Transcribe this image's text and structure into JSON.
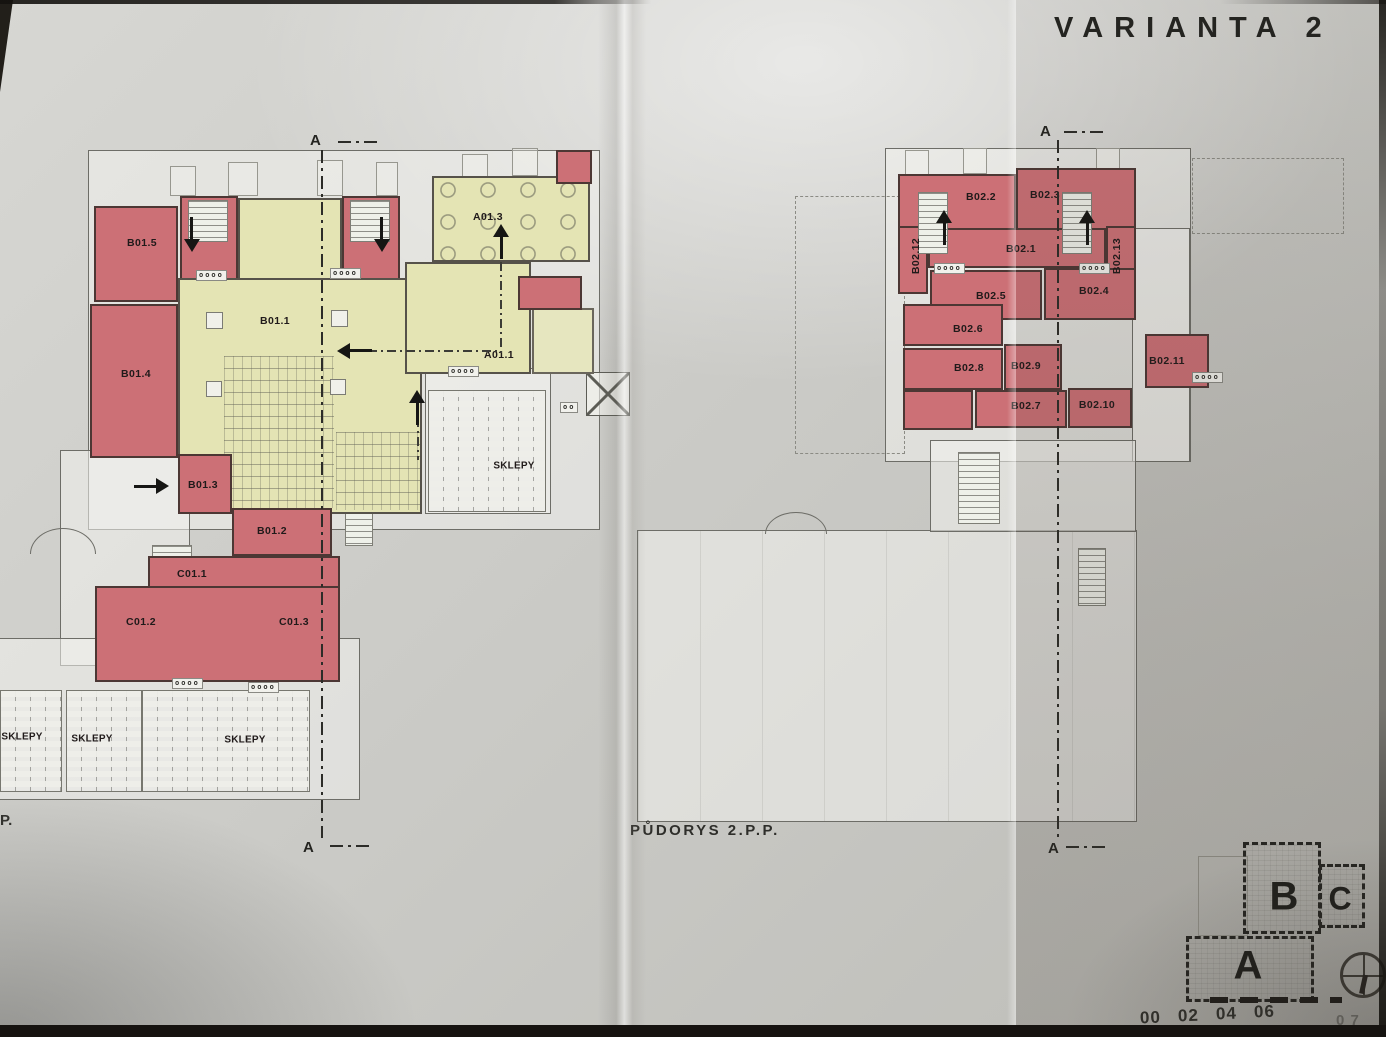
{
  "title": "VARIANTA 2",
  "left_plan": {
    "rooms": {
      "b01_1": "B01.1",
      "b01_2": "B01.2",
      "b01_3": "B01.3",
      "b01_4": "B01.4",
      "b01_5": "B01.5",
      "a01_1": "A01.1",
      "a01_3": "A01.3",
      "c01_1": "C01.1",
      "c01_2": "C01.2",
      "c01_3": "C01.3"
    },
    "sklepy_mid": "SKLEPY",
    "sklepy_cells": [
      "SKLEPY",
      "SKLEPY",
      "SKLEPY"
    ],
    "section_top": "A",
    "section_bottom": "A",
    "caption_partial": "P."
  },
  "right_plan": {
    "caption": "PŮDORYS 2.P.P.",
    "rooms": {
      "b02_1": "B02.1",
      "b02_2": "B02.2",
      "b02_3": "B02.3",
      "b02_4": "B02.4",
      "b02_5": "B02.5",
      "b02_6": "B02.6",
      "b02_7": "B02.7",
      "b02_8": "B02.8",
      "b02_9": "B02.9",
      "b02_10": "B02.10",
      "b02_11": "B02.11",
      "b02_12": "B02.12",
      "b02_13": "B02.13"
    },
    "section_top": "A",
    "section_bottom": "A"
  },
  "key_plan": {
    "block_b": "B",
    "block_c": "C",
    "block_a": "A",
    "scale_ticks": [
      "00",
      "02",
      "04",
      "06"
    ],
    "corner_partial": "0 7"
  },
  "decor": {
    "circles4": "oooo",
    "circles2": "oo"
  },
  "colors": {
    "room_red": "#cc7076",
    "room_yellow": "#e4e4b4",
    "paper": "#c9c9c5",
    "ink": "#262420"
  }
}
